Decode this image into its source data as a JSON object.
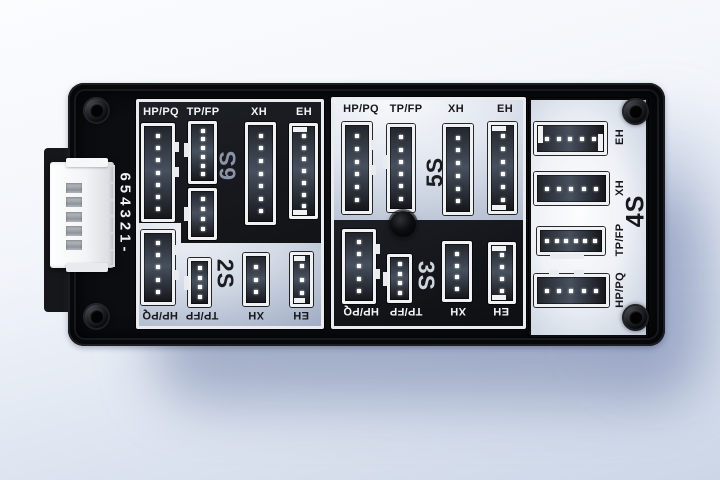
{
  "board": {
    "side_marking": "654321-",
    "output_connector": {
      "slots": 5
    },
    "colors": {
      "board_body": "#0c0d10",
      "panel_frame": "#e9ebee",
      "dark_section": "#14161a",
      "light_section": "#dfe5ef",
      "label_on_dark": "#f3f4f6",
      "label_on_light": "#17181c",
      "s6_label_color": "#8b93a5",
      "s3_label_color": "#cfd4dd"
    },
    "sections": {
      "s6": {
        "label": "6S",
        "header_labels": [
          "HP/PQ",
          "TP/FP",
          "XH",
          "EH"
        ],
        "connectors": [
          {
            "type": "HP/PQ",
            "pins": 7
          },
          {
            "type": "TP/FP",
            "pins": 6
          },
          {
            "type": "TP/FP",
            "pins": 4
          },
          {
            "type": "XH",
            "pins": 7
          },
          {
            "type": "EH",
            "pins": 7
          }
        ]
      },
      "s2": {
        "label": "2S",
        "footer_labels": [
          "HP/PQ",
          "TP/FP",
          "XH",
          "EH"
        ],
        "connectors": [
          {
            "type": "HP/PQ",
            "pins": 5
          },
          {
            "type": "TP/FP",
            "pins": 4
          },
          {
            "type": "XH",
            "pins": 3
          },
          {
            "type": "EH",
            "pins": 3
          }
        ]
      },
      "s5": {
        "label": "5S",
        "header_labels": [
          "HP/PQ",
          "TP/FP",
          "XH",
          "EH"
        ],
        "connectors": [
          {
            "type": "HP/PQ",
            "pins": 6
          },
          {
            "type": "TP/FP",
            "pins": 6
          },
          {
            "type": "XH",
            "pins": 6
          },
          {
            "type": "EH",
            "pins": 6
          }
        ]
      },
      "s3": {
        "label": "3S",
        "footer_labels": [
          "HP/PQ",
          "TP/FP",
          "XH",
          "EH"
        ],
        "connectors": [
          {
            "type": "HP/PQ",
            "pins": 5
          },
          {
            "type": "TP/FP",
            "pins": 4
          },
          {
            "type": "XH",
            "pins": 4
          },
          {
            "type": "EH",
            "pins": 4
          }
        ]
      },
      "s4": {
        "label": "4S",
        "side_labels": [
          "EH",
          "XH",
          "TP/FP",
          "HP/PQ"
        ],
        "connectors": [
          {
            "type": "EH",
            "pins": 5
          },
          {
            "type": "XH",
            "pins": 5
          },
          {
            "type": "TP/FP",
            "pins": 6
          },
          {
            "type": "HP/PQ",
            "pins": 5
          }
        ]
      }
    }
  }
}
